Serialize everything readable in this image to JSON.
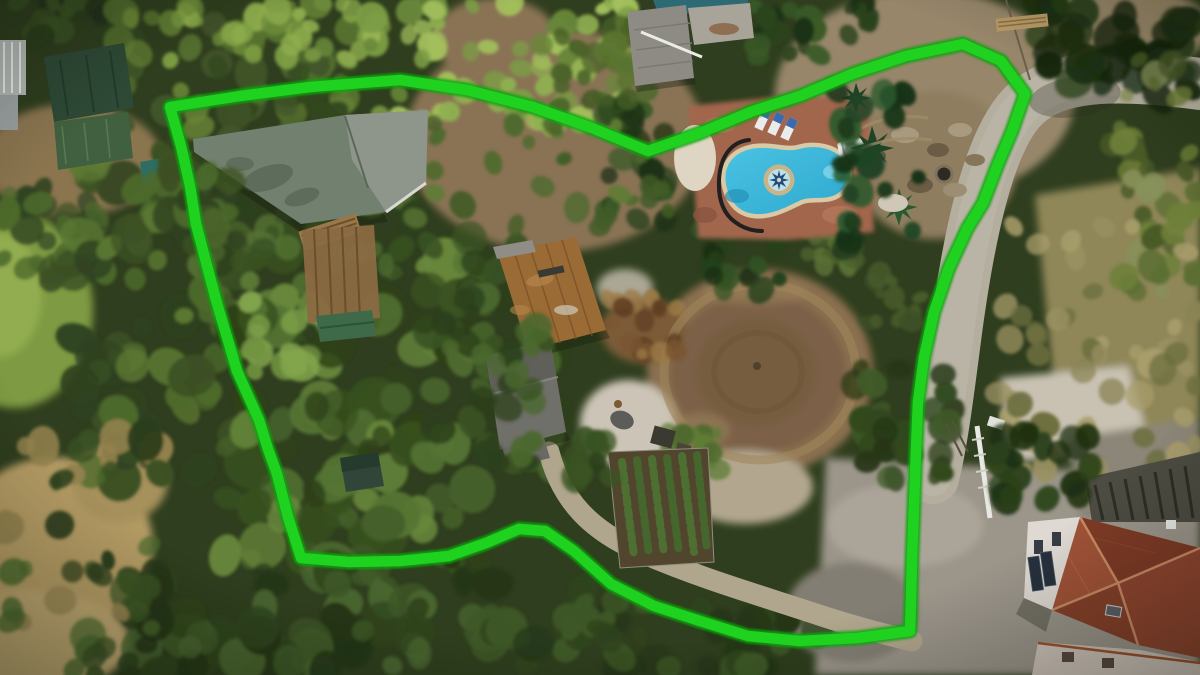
{
  "meta": {
    "type": "aerial-drone-photograph",
    "subject": "rural finca property marked with a bright green boundary outline",
    "width": 1200,
    "height": 675,
    "visible_text": "none"
  },
  "palette": {
    "boundary_green": "#1fd21f",
    "boundary_halo": "#0da30d",
    "canopy_base": "#2f3e1e",
    "pool_water": "#2fa9cf",
    "pool_water_light": "#7fd4ea",
    "pool_coping": "#d9c9a4",
    "deck_terracotta": "#a2664d",
    "warehouse_roof": "#71806f",
    "warehouse_roof_light": "#8e968b",
    "green_roof_dark": "#2e4936",
    "green_roof_mid": "#41603f",
    "rust_roof": "#9a6b35",
    "gray_roof": "#70706a",
    "house_roof_red": "#8f4630",
    "house_roof_ridge": "#c98a64",
    "house_wall": "#ded9d2",
    "road": "#b4ae9f",
    "road_light": "#c0baab",
    "concrete": "#9b958a",
    "dirt": "#8a7354",
    "ring_outer": "#8a7050",
    "ring_inner": "#775d40",
    "dry_grass": "#b29a64",
    "grass_field": "#7e9a42",
    "ash_white": "#ccc4b6",
    "gravel_white": "#c9c2b2"
  },
  "boundary": {
    "stroke_width": 10.5,
    "halo_width": 15,
    "points_attr": "170,107 240,96 310,87 400,80 467,90 533,107 592,128 648,151 700,133 753,111 800,96 852,74 906,56 963,44 1001,61 1025,94 1012,131 998,164 983,203 967,229 949,268 934,312 924,357 918,402 916,450 914,505 912,558 911,600 910,631 858,638 800,641 748,636 700,621 654,606 611,584 574,551 545,531 519,529 486,543 449,556 400,561 349,562 301,558 288,517 277,474 268,449 259,420 237,371 216,300 196,224 190,186 181,146 170,107"
  },
  "landmarks": [
    {
      "name": "property-boundary-line",
      "desc": "thick bright green freeform outline around the plot"
    },
    {
      "name": "swimming-pool",
      "desc": "freeform turquoise pool with tan coping and compass-rose medallion, terracotta deck, sun loungers"
    },
    {
      "name": "riding-ring",
      "desc": "large circular tan dirt ring in plot center"
    },
    {
      "name": "warehouse-building",
      "desc": "large sage gray-green roof inside north-west boundary"
    },
    {
      "name": "rust-roof-building",
      "desc": "weathered corrugated rust/brown roof, center of plot"
    },
    {
      "name": "gray-roof-building",
      "desc": "gray shingled roof south of rust building"
    },
    {
      "name": "left-green-roof-buildings",
      "desc": "two dark green metal roofs outside boundary, far left"
    },
    {
      "name": "top-center-building",
      "desc": "gray roofed shed with concrete pad, north neighbor"
    },
    {
      "name": "neighbor-pool",
      "desc": "teal pool edge at very top"
    },
    {
      "name": "red-roof-house",
      "desc": "hip red-tile roof house with white facade, bottom right"
    },
    {
      "name": "access-road",
      "desc": "light gray road along east side"
    },
    {
      "name": "driveway",
      "desc": "S-curved gravel drive from plot center to south-east gate"
    },
    {
      "name": "garden-rows",
      "desc": "rows of young trees in fenced nursery plot, bottom center"
    },
    {
      "name": "rock-mound",
      "desc": "rocky excavated mound east of pool with round well"
    },
    {
      "name": "grass-field",
      "desc": "green pasture at far west edge"
    },
    {
      "name": "dry-grass",
      "desc": "tan dry meadow, south-west corner"
    }
  ],
  "ground_patches": [
    {
      "name": "dirt-top-center",
      "cx": 555,
      "cy": 140,
      "rx": 150,
      "ry": 112,
      "fill": "#8a7354"
    },
    {
      "name": "dirt-top-small",
      "cx": 495,
      "cy": 38,
      "rx": 62,
      "ry": 40,
      "fill": "#8a7354"
    },
    {
      "name": "dirt-top-right",
      "cx": 925,
      "cy": 95,
      "rx": 150,
      "ry": 105,
      "fill": "#97866a"
    },
    {
      "name": "dirt-tr-corner",
      "cx": 1125,
      "cy": 28,
      "rx": 85,
      "ry": 42,
      "fill": "#9b8a6a"
    },
    {
      "name": "rock-mound-base",
      "cx": 935,
      "cy": 165,
      "rx": 82,
      "ry": 74,
      "fill": "#8f7d5f"
    },
    {
      "name": "dirt-left",
      "cx": 72,
      "cy": 160,
      "rx": 90,
      "ry": 56,
      "fill": "#8a744f"
    },
    {
      "name": "grass-field",
      "cx": 15,
      "cy": 310,
      "rx": 78,
      "ry": 98,
      "fill": "#7e9a42"
    },
    {
      "name": "grass-bright",
      "cx": 0,
      "cy": 295,
      "rx": 42,
      "ry": 62,
      "fill": "#92ad50"
    },
    {
      "name": "right-tan-base",
      "pts": "1035,195 1200,168 1200,435 1058,432",
      "fill": "#8f8758"
    },
    {
      "name": "dry-bl-1",
      "cx": 55,
      "cy": 545,
      "rx": 98,
      "ry": 88,
      "fill": "#b29a64"
    },
    {
      "name": "dry-bl-2",
      "cx": 25,
      "cy": 642,
      "rx": 105,
      "ry": 52,
      "fill": "#bca670"
    },
    {
      "name": "dry-bl-3",
      "cx": 120,
      "cy": 480,
      "rx": 48,
      "ry": 42,
      "fill": "#a6905c"
    },
    {
      "name": "ring-outer",
      "cx": 760,
      "cy": 372,
      "rx": 113,
      "ry": 103,
      "fill": "#8a7050"
    },
    {
      "name": "ring-mid",
      "cx": 758,
      "cy": 373,
      "rx": 88,
      "ry": 80,
      "fill": "#7b6147"
    },
    {
      "name": "ring-inner",
      "cx": 756,
      "cy": 372,
      "rx": 60,
      "ry": 54,
      "fill": "#775d40"
    },
    {
      "name": "ring-top-light",
      "cx": 755,
      "cy": 292,
      "rx": 52,
      "ry": 13,
      "fill": "#9c8259",
      "op": 0.55
    },
    {
      "name": "ring-bl-light",
      "cx": 700,
      "cy": 430,
      "rx": 30,
      "ry": 17,
      "fill": "#97805a",
      "op": 0.6
    },
    {
      "name": "ash-area",
      "cx": 628,
      "cy": 424,
      "rx": 48,
      "ry": 44,
      "fill": "#ccc4b6"
    },
    {
      "name": "white-circles",
      "cx": 625,
      "cy": 288,
      "rx": 28,
      "ry": 19,
      "fill": "#c1baa9",
      "op": 0.85
    },
    {
      "name": "debris-base",
      "cx": 643,
      "cy": 330,
      "rx": 42,
      "ry": 33,
      "fill": "#7c5c38"
    },
    {
      "name": "gravel-apron",
      "cx": 745,
      "cy": 487,
      "rx": 68,
      "ry": 37,
      "fill": "#b2a78e"
    },
    {
      "name": "concrete-pad",
      "pts": "826,458 1010,468 1080,470 1200,498 1200,675 815,675",
      "fill": "#9b958a"
    },
    {
      "name": "pad-light",
      "cx": 905,
      "cy": 525,
      "rx": 78,
      "ry": 42,
      "fill": "#aba599"
    },
    {
      "name": "pad-dark",
      "cx": 852,
      "cy": 612,
      "rx": 66,
      "ry": 50,
      "fill": "#837e73"
    },
    {
      "name": "white-gravel",
      "pts": "1000,378 1128,366 1152,452 1008,462",
      "fill": "#c9c2b2"
    },
    {
      "name": "tr-house-concrete",
      "pts": "1068,438 1200,418 1200,500 1080,520",
      "fill": "#8c8678"
    }
  ],
  "vegetation_regions": [
    {
      "name": "corner-tl",
      "x": 0,
      "y": 0,
      "w": 125,
      "h": 48,
      "n": 18,
      "rmin": 8,
      "rmax": 18,
      "colors": [
        "#2c3e1c",
        "#3a5124",
        "#24331a"
      ]
    },
    {
      "name": "tl-woodland",
      "x": 118,
      "y": 0,
      "w": 265,
      "h": 150,
      "n": 60,
      "rmin": 8,
      "rmax": 20,
      "colors": [
        "#42562b",
        "#55702f",
        "#33471f",
        "#678336"
      ]
    },
    {
      "name": "tl-bright",
      "x": 150,
      "y": 0,
      "w": 230,
      "h": 62,
      "n": 32,
      "rmin": 6,
      "rmax": 14,
      "colors": [
        "#6d8c3a",
        "#7fa044",
        "#8fae4e"
      ]
    },
    {
      "name": "top-bright-grove",
      "x": 368,
      "y": 0,
      "w": 262,
      "h": 138,
      "n": 68,
      "rmin": 7,
      "rmax": 16,
      "colors": [
        "#7c9d45",
        "#8fb050",
        "#a3c05c",
        "#68873a"
      ]
    },
    {
      "name": "top-mid-dark",
      "x": 558,
      "y": 16,
      "w": 88,
      "h": 92,
      "n": 20,
      "rmin": 7,
      "rmax": 14,
      "colors": [
        "#4a6228",
        "#5a7430",
        "#3c521f"
      ]
    },
    {
      "name": "left-edge",
      "x": 0,
      "y": 178,
      "w": 105,
      "h": 112,
      "n": 26,
      "rmin": 8,
      "rmax": 18,
      "colors": [
        "#3c5124",
        "#4d6a2c",
        "#2f4220"
      ]
    },
    {
      "name": "left-column",
      "x": 58,
      "y": 150,
      "w": 185,
      "h": 332,
      "n": 75,
      "rmin": 9,
      "rmax": 22,
      "colors": [
        "#3c5124",
        "#4d6a2c",
        "#2f4220",
        "#5d7a33"
      ]
    },
    {
      "name": "mid-left-canopy",
      "x": 218,
      "y": 238,
      "w": 272,
      "h": 330,
      "n": 90,
      "rmin": 9,
      "rmax": 24,
      "colors": [
        "#45602a",
        "#567534",
        "#38511f",
        "#68883c",
        "#2e4119"
      ]
    },
    {
      "name": "under-warehouse",
      "x": 188,
      "y": 182,
      "w": 242,
      "h": 92,
      "n": 38,
      "rmin": 8,
      "rmax": 16,
      "colors": [
        "#3a5323",
        "#4a682e",
        "#2c401b",
        "#567233"
      ]
    },
    {
      "name": "center-clump",
      "x": 424,
      "y": 238,
      "w": 138,
      "h": 232,
      "n": 46,
      "rmin": 8,
      "rmax": 20,
      "colors": [
        "#3a5323",
        "#4a682e",
        "#2c401b"
      ]
    },
    {
      "name": "bright-round-trees",
      "x": 246,
      "y": 298,
      "w": 92,
      "h": 82,
      "n": 18,
      "rmin": 8,
      "rmax": 16,
      "colors": [
        "#6f9040",
        "#82a54c"
      ]
    },
    {
      "name": "v-dip-clump",
      "x": 600,
      "y": 96,
      "w": 66,
      "h": 126,
      "n": 24,
      "rmin": 8,
      "rmax": 16,
      "colors": [
        "#2c451f",
        "#1f3316",
        "#3a5a28"
      ]
    },
    {
      "name": "top-dirt-bushes",
      "x": 430,
      "y": 90,
      "w": 240,
      "h": 140,
      "n": 28,
      "rmin": 6,
      "rmax": 13,
      "colors": [
        "#4f6a2e",
        "#5f7c36",
        "#435c26"
      ]
    },
    {
      "name": "pool-top-palms",
      "x": 742,
      "y": 0,
      "w": 128,
      "h": 60,
      "n": 24,
      "rmin": 7,
      "rmax": 14,
      "colors": [
        "#2c451f",
        "#3a5a28",
        "#1f3316"
      ]
    },
    {
      "name": "pool-circle-palms",
      "x": 698,
      "y": 226,
      "w": 84,
      "h": 70,
      "n": 18,
      "rmin": 7,
      "rmax": 14,
      "colors": [
        "#24401c",
        "#325225",
        "#1b2f12"
      ]
    },
    {
      "name": "debris-browns",
      "x": 605,
      "y": 298,
      "w": 75,
      "h": 60,
      "n": 18,
      "rmin": 5,
      "rmax": 12,
      "colors": [
        "#7a5531",
        "#8f6a3a",
        "#5f3f22",
        "#9c7a45"
      ]
    },
    {
      "name": "rock-bushes",
      "x": 795,
      "y": 218,
      "w": 72,
      "h": 58,
      "n": 16,
      "rmin": 6,
      "rmax": 12,
      "colors": [
        "#4a5e2c",
        "#5a7034"
      ]
    },
    {
      "name": "mound-bushes",
      "x": 868,
      "y": 262,
      "w": 60,
      "h": 62,
      "n": 12,
      "rmin": 6,
      "rmax": 12,
      "colors": [
        "#4a5e2c",
        "#3c5026"
      ]
    },
    {
      "name": "circle-right-trees",
      "x": 852,
      "y": 368,
      "w": 104,
      "h": 112,
      "n": 28,
      "rmin": 8,
      "rmax": 18,
      "colors": [
        "#31481f",
        "#3f5a28",
        "#263716"
      ]
    },
    {
      "name": "tr-big-tree",
      "x": 1038,
      "y": 0,
      "w": 154,
      "h": 98,
      "n": 40,
      "rmin": 9,
      "rmax": 22,
      "colors": [
        "#1e3012",
        "#2a421a",
        "#16260e"
      ]
    },
    {
      "name": "right-hedge",
      "x": 1112,
      "y": 55,
      "w": 86,
      "h": 248,
      "n": 42,
      "rmin": 7,
      "rmax": 15,
      "colors": [
        "#5c6e33",
        "#6e8038",
        "#4a5a28",
        "#87915a"
      ]
    },
    {
      "name": "right-dry-brush",
      "x": 998,
      "y": 225,
      "w": 198,
      "h": 266,
      "n": 52,
      "rmin": 7,
      "rmax": 15,
      "colors": [
        "#8a8454",
        "#9a9162",
        "#6e7040",
        "#a89d6b"
      ]
    },
    {
      "name": "bottom-left-wood",
      "x": 128,
      "y": 552,
      "w": 366,
      "h": 123,
      "n": 68,
      "rmin": 9,
      "rmax": 24,
      "colors": [
        "#2f441d",
        "#3e5827",
        "#253618",
        "#4a6630"
      ]
    },
    {
      "name": "bottom-mid-strip",
      "x": 488,
      "y": 612,
      "w": 332,
      "h": 63,
      "n": 36,
      "rmin": 9,
      "rmax": 20,
      "colors": [
        "#2f441d",
        "#3e5827",
        "#253618"
      ]
    },
    {
      "name": "bl-scattered",
      "x": 0,
      "y": 428,
      "w": 165,
      "h": 247,
      "n": 38,
      "rmin": 8,
      "rmax": 18,
      "colors": [
        "#3a5124",
        "#2c3e1c",
        "#4c6a2e",
        "#93824e"
      ]
    },
    {
      "name": "below-bump-trees",
      "x": 556,
      "y": 580,
      "w": 90,
      "h": 60,
      "n": 16,
      "rmin": 8,
      "rmax": 16,
      "colors": [
        "#2f441d",
        "#3e5827"
      ]
    },
    {
      "name": "garden-right-greens",
      "x": 648,
      "y": 430,
      "w": 72,
      "h": 42,
      "n": 12,
      "rmin": 6,
      "rmax": 12,
      "colors": [
        "#4f6a2e",
        "#5f7c36"
      ]
    },
    {
      "name": "over-warehouse-left",
      "layer": "front",
      "x": 148,
      "y": 148,
      "w": 95,
      "h": 102,
      "n": 24,
      "rmin": 8,
      "rmax": 18,
      "colors": [
        "#3c5124",
        "#2f4220",
        "#4d6a2c"
      ]
    },
    {
      "name": "over-rust-left",
      "layer": "front",
      "x": 460,
      "y": 296,
      "w": 84,
      "h": 168,
      "n": 26,
      "rmin": 8,
      "rmax": 18,
      "colors": [
        "#3a5323",
        "#2c401b",
        "#4a682e"
      ]
    },
    {
      "name": "pool-right-palms",
      "layer": "front",
      "x": 836,
      "y": 88,
      "w": 84,
      "h": 162,
      "n": 24,
      "rmin": 7,
      "rmax": 16,
      "colors": [
        "#1f4425",
        "#2a5a2e",
        "#173318"
      ]
    },
    {
      "name": "over-pad-trees",
      "layer": "front",
      "x": 996,
      "y": 432,
      "w": 96,
      "h": 72,
      "n": 18,
      "rmin": 8,
      "rmax": 16,
      "colors": [
        "#2a421a",
        "#1e3012"
      ]
    },
    {
      "name": "drive-start-trees",
      "layer": "front",
      "x": 556,
      "y": 424,
      "w": 64,
      "h": 56,
      "n": 12,
      "rmin": 7,
      "rmax": 14,
      "colors": [
        "#3a5323",
        "#2c401b"
      ]
    }
  ]
}
